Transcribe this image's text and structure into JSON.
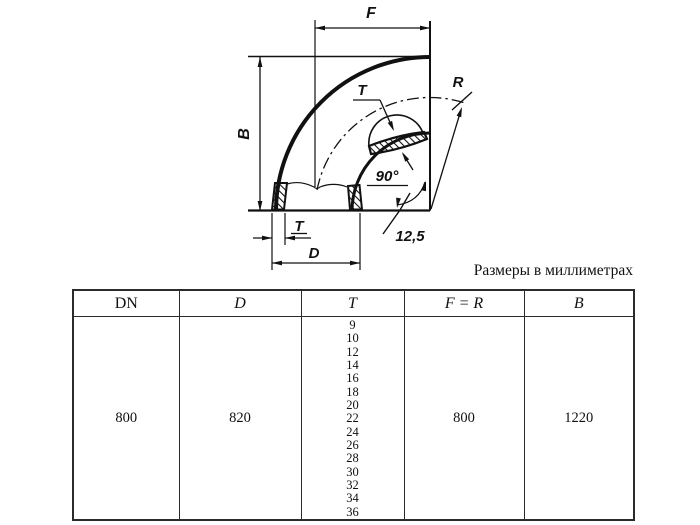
{
  "caption": "Размеры в миллиметрах",
  "drawing": {
    "labels": {
      "f": "F",
      "b": "B",
      "t_top": "T",
      "t_bottom": "T",
      "d": "D",
      "angle": "90°",
      "roughness": "12,5",
      "r": "R"
    }
  },
  "table": {
    "columns": [
      "DN",
      "D",
      "T",
      "F = R",
      "B"
    ],
    "row": {
      "dn": "800",
      "d": "820",
      "t_values": [
        "9",
        "10",
        "12",
        "14",
        "16",
        "18",
        "20",
        "22",
        "24",
        "26",
        "28",
        "30",
        "32",
        "34",
        "36"
      ],
      "f_r": "800",
      "b": "1220"
    }
  },
  "colors": {
    "line": "#111111",
    "table_border": "#2b2b2b",
    "background": "#ffffff"
  }
}
